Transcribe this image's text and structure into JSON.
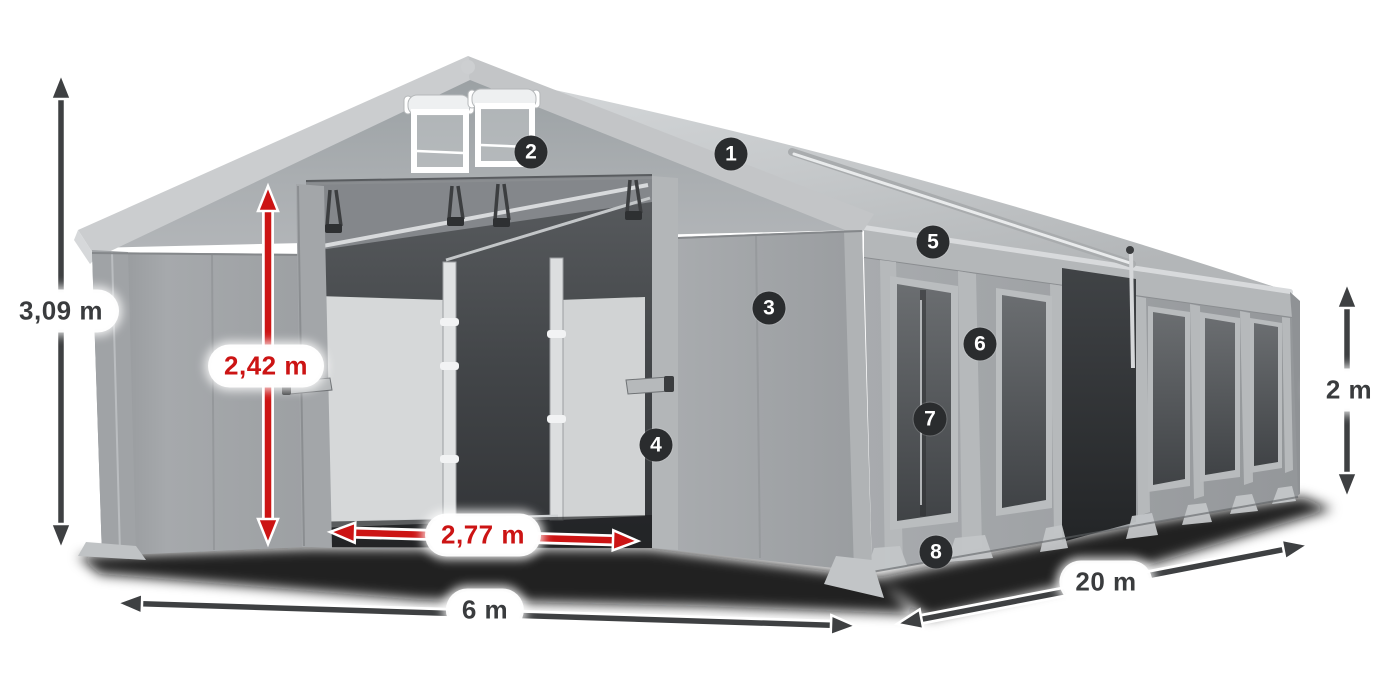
{
  "diagram": {
    "subject": "party-tent-dimensions-diagram",
    "background_color": "#ffffff",
    "dimension_labels": {
      "total_height": {
        "text": "3,09 m",
        "style": "dark"
      },
      "door_height": {
        "text": "2,42 m",
        "style": "red"
      },
      "door_width": {
        "text": "2,77 m",
        "style": "red"
      },
      "front_width": {
        "text": "6 m",
        "style": "dark"
      },
      "side_length": {
        "text": "20 m",
        "style": "dark"
      },
      "side_wall_height": {
        "text": "2 m",
        "style": "dark"
      }
    },
    "callouts": [
      {
        "number": "1"
      },
      {
        "number": "2"
      },
      {
        "number": "3"
      },
      {
        "number": "4"
      },
      {
        "number": "5"
      },
      {
        "number": "6"
      },
      {
        "number": "7"
      },
      {
        "number": "8"
      }
    ],
    "colors": {
      "dimension_arrow_dark": "#3e4042",
      "dimension_arrow_red": "#cc1414",
      "label_background": "#ffffff",
      "label_text_dark": "#3a3c3e",
      "label_text_red": "#cc1414",
      "callout_background": "#2a2c2e",
      "callout_text": "#ffffff",
      "tent_fabric_gray": "#a6a9ac",
      "roof_gray": "#c6c9cb",
      "window_dark": "#4a4d50"
    }
  }
}
